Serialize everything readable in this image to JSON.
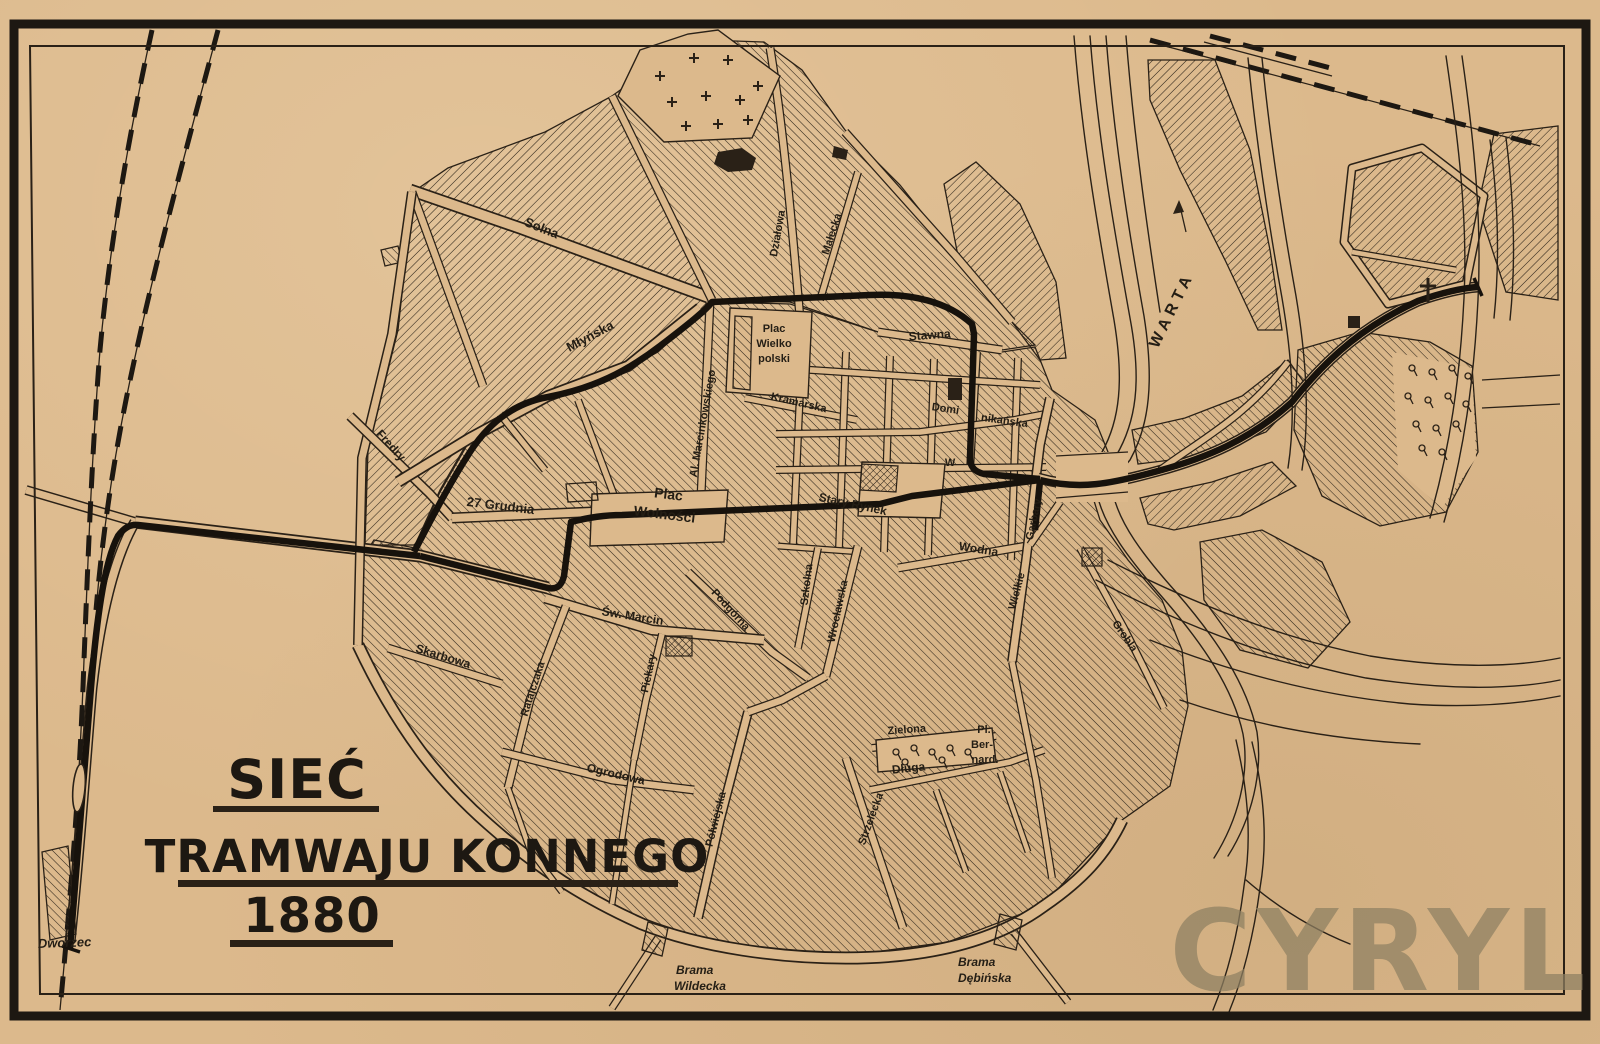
{
  "map": {
    "title": {
      "line1": "SIEĆ",
      "line2": "TRAMWAJU KONNEGO",
      "line3": "1880"
    },
    "watermark": "CYRYL",
    "river_label": "WARTA",
    "station_label": "Dworzec",
    "gate_wildecka": {
      "line1": "Brama",
      "line2": "Wildecka"
    },
    "gate_debinska": {
      "line1": "Brama",
      "line2": "Dębińska"
    },
    "colors": {
      "paper": "#dcb98c",
      "ink": "#2a2117",
      "tram": "#17120c",
      "watermark": "#8e8062"
    }
  },
  "streets": {
    "solna": "Solna",
    "mlynska": "Młyńska",
    "fredry": "Fredry",
    "grudnia": "27 Grudnia",
    "plac_wolnosci_1": "Plac",
    "plac_wolnosci_2": "Wolności",
    "marcinkowskiego": "Al. Marcinkowskiego",
    "plac_wielkopolski_1": "Plac",
    "plac_wielkopolski_2": "Wielko",
    "plac_wielkopolski_3": "polski",
    "kramarska": "Kramarska",
    "stawna": "Stawna",
    "dominikanska_1": "Domi",
    "dominikanska_2": "nikańska",
    "stary_rynek": "Stary Rynek",
    "wielka_partial": "W",
    "wodna": "Wodna",
    "wielkie": "Wielkie",
    "garbary": "Garbary",
    "grobla": "Grobla",
    "szkolna": "Szkolna",
    "wroclawska": "Wrocławska",
    "sw_marcin": "Św. Marcin",
    "skarbowa": "Skarbowa",
    "ratajczaka": "Ratajczaka",
    "piekary": "Piekary",
    "ogrodowa": "Ogrodowa",
    "podgorna": "Podgórna",
    "polwiejska": "Półwiejska",
    "zielona": "Zielona",
    "pl_bernard_1": "Pl.",
    "pl_bernard_2": "Ber-",
    "pl_bernard_3": "nard.",
    "dluga": "Długa",
    "strzelecka": "Strzelecka",
    "dzialowa": "Działowa",
    "malecka": "Małecka"
  }
}
